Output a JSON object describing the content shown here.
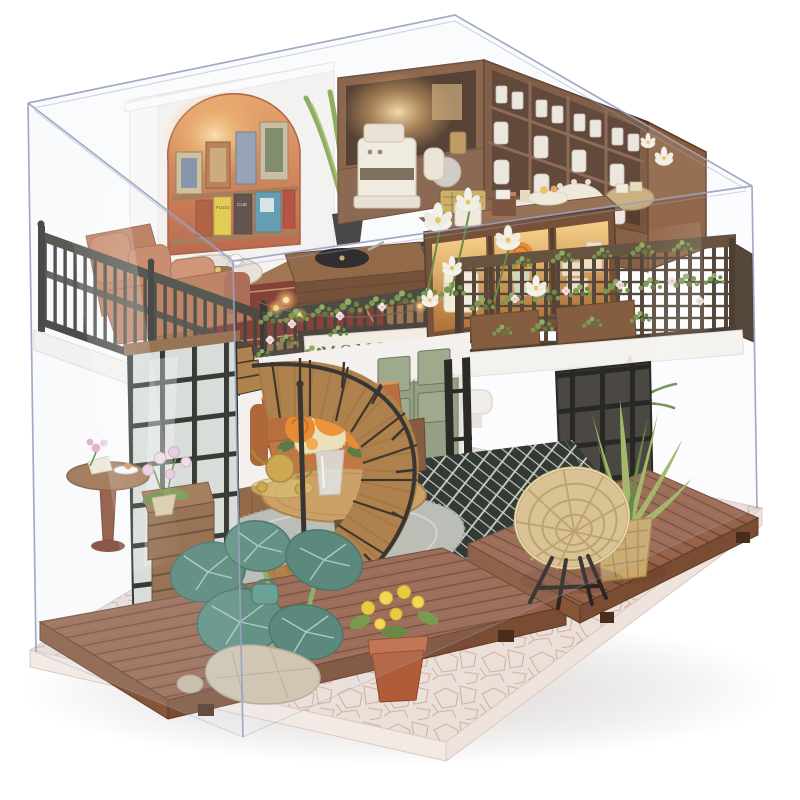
{
  "image": {
    "kind": "product-photo",
    "subject": "DIY miniature dollhouse kit: two-story MOMO TEA tea-shop diorama displayed inside a clear acrylic dust-proof case on a stone-tile base",
    "background_color": "#ffffff"
  },
  "signboard": {
    "text": "MOMO TEA"
  },
  "book_spines": {
    "yellow": "FUDG",
    "dark": "CUE"
  },
  "colors": {
    "pageBg": "#ffffff",
    "acrylicEdge": "#99a2c2",
    "baseStone": "#ebdfd9",
    "stoneCrack": "#c8a48c",
    "deckWood": "#96624a",
    "deckLine": "#6f4530",
    "deckFace": "#7a4c33",
    "wallWhite": "#f8f5f1",
    "archTop": "#e89a56",
    "archBottom": "#b4512c",
    "hutchWood": "#7b4f2e",
    "hutchDark": "#3d2413",
    "counterWood": "#7d5234",
    "railingDark": "#34342b",
    "railingBrown": "#473626",
    "sofaTerracotta": "#c67a55",
    "sofaOrange": "#bf6a2f",
    "pillowCream": "#ece0b4",
    "roseOrange": "#e8831f",
    "leafGreen": "#6f9240",
    "leafDark": "#4e7030",
    "fernGreen": "#9cb45c",
    "taroGreen": "#4c7f70",
    "taroVein": "#a8c9bb",
    "signBoard": "#f5eee1",
    "signFrame": "#3a352b",
    "signText": "#564f43",
    "checkerDark": "#20261f",
    "checkerLight": "#c6cec0",
    "tealDark": "#233732",
    "tealLight": "#54807c",
    "rugRed": "#7c2f26",
    "rugTrim": "#caa36a",
    "grayRug": "#b6bab0",
    "rattan": "#d9c089",
    "rattanRim": "#b89d60",
    "terracotta": "#b05c38",
    "gold": "#c9a23f",
    "doorGreen": "#8d9879",
    "glassBlue": "#e4eef2",
    "cream": "#f2ead8",
    "glow": "#ffd878"
  },
  "scene": {
    "objects": [
      "acrylic display case",
      "stone-tile display base",
      "front wooden deck",
      "side wooden deck",
      "spiral staircase",
      "MOMO TEA signboard",
      "arched book nook with framed art",
      "corner coffee bar with espresso machine",
      "china shelf hutch with white jars",
      "lit cake display cabinet",
      "balcony railings with flower vines and string lights",
      "terracotta balcony sofa",
      "gramophone on wooden crate",
      "balcony tea table with cups",
      "orange sofa with cream pillow",
      "round table with orange roses in glass vase",
      "gold tea set",
      "sage green double door",
      "black lattice windows",
      "wicker papasan chair",
      "potted fern",
      "hanging macrame planter",
      "taro plant",
      "terracotta pot with yellow flowers",
      "dessert pedestal table",
      "wooden crates with pink orchid",
      "garden rock",
      "white lily flowers"
    ]
  }
}
